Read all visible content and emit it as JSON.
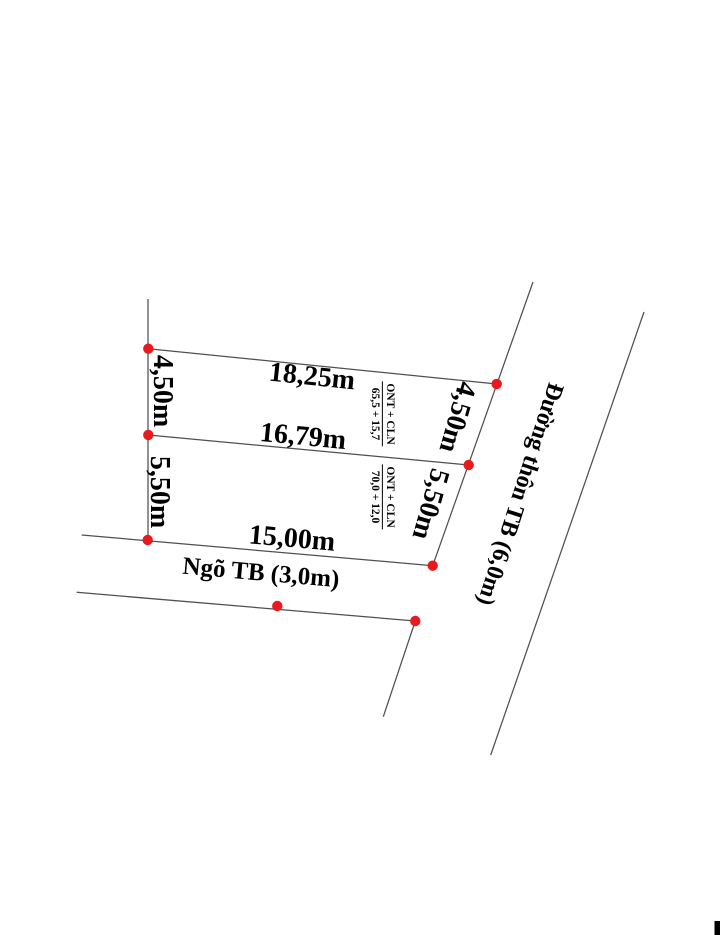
{
  "colors": {
    "dot": "#e8191f",
    "line": "#4f4f4f",
    "text": "#000000"
  },
  "parcels": [
    {
      "land_use": "ONT + CLN",
      "area_split": "65,5 + 15,7",
      "front_dim": "18,25m",
      "left_dim": "4,50m",
      "right_dim": "4,50m"
    },
    {
      "land_use": "ONT + CLN",
      "area_split": "70,0 + 12,0",
      "front_dim": "16,79m",
      "left_dim": "5,50m",
      "right_dim": "5,50m",
      "rear_dim": "15,00m"
    }
  ],
  "roads": {
    "alley_label": "Ngõ TB (3,0m)",
    "main_road_label": "Đường thôn TB (6,0m)"
  }
}
